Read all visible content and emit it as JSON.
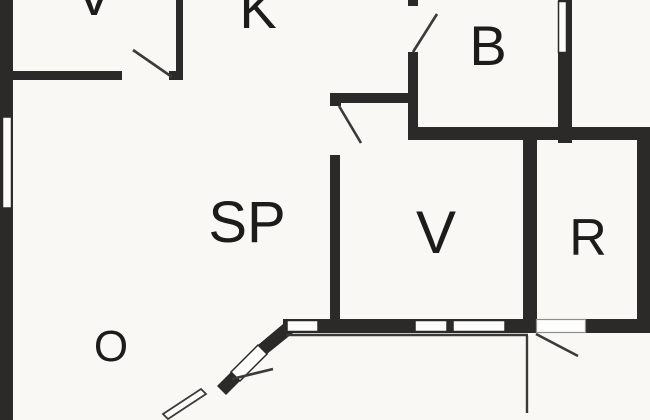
{
  "plan": {
    "rooms": [
      {
        "id": "v-top",
        "label": "V"
      },
      {
        "id": "k",
        "label": "K"
      },
      {
        "id": "b",
        "label": "B"
      },
      {
        "id": "sp",
        "label": "SP"
      },
      {
        "id": "v-mid",
        "label": "V"
      },
      {
        "id": "r",
        "label": "R"
      },
      {
        "id": "o",
        "label": "O"
      }
    ]
  },
  "colors": {
    "wall": "#2b2a28",
    "background": "#f9f8f5",
    "window_fill": "#fdfdfb",
    "thin_line": "#3b3a38",
    "label": "#1d1c1a",
    "threshold_outline": "#8f8e8b"
  }
}
